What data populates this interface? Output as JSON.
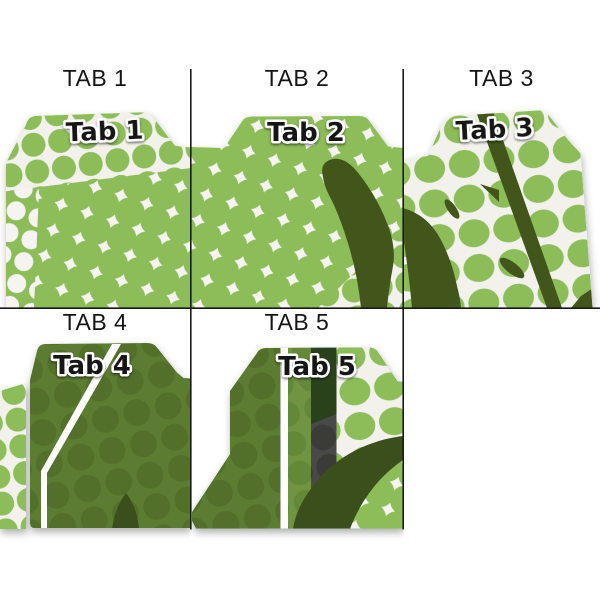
{
  "image_title": "File folder tab position options",
  "colors": {
    "page_bg": "#ffffff",
    "grid_line": "#1a1a1a",
    "label_text": "#151515",
    "tab_text": "#121212",
    "tab_text_outline": "#ffffff",
    "lime_green": "#8cbd58",
    "pattern_offwhite": "#f2f1ec",
    "diamond_white": "#f5f4f0",
    "dark_branch": "#42561f",
    "olive_green": "#5c7c33",
    "olive_dot": "#527029",
    "dark_leaf": "#3a4f1d",
    "band_green": "#6f9442",
    "band_green_dot": "#648939",
    "dark_band_green": "#2c421b",
    "gray_band": "#4a4a48",
    "gray_band_dot": "#3b3b39",
    "stripe_white": "#ffffff"
  },
  "cells": [
    {
      "label": "TAB 1",
      "tab_label": "Tab 1",
      "tab_position": "left"
    },
    {
      "label": "TAB 2",
      "tab_label": "Tab 2",
      "tab_position": "center"
    },
    {
      "label": "TAB 3",
      "tab_label": "Tab 3",
      "tab_position": "center"
    },
    {
      "label": "TAB 4",
      "tab_label": "Tab 4",
      "tab_position": "left"
    },
    {
      "label": "TAB 5",
      "tab_label": "Tab 5",
      "tab_position": "center"
    }
  ]
}
